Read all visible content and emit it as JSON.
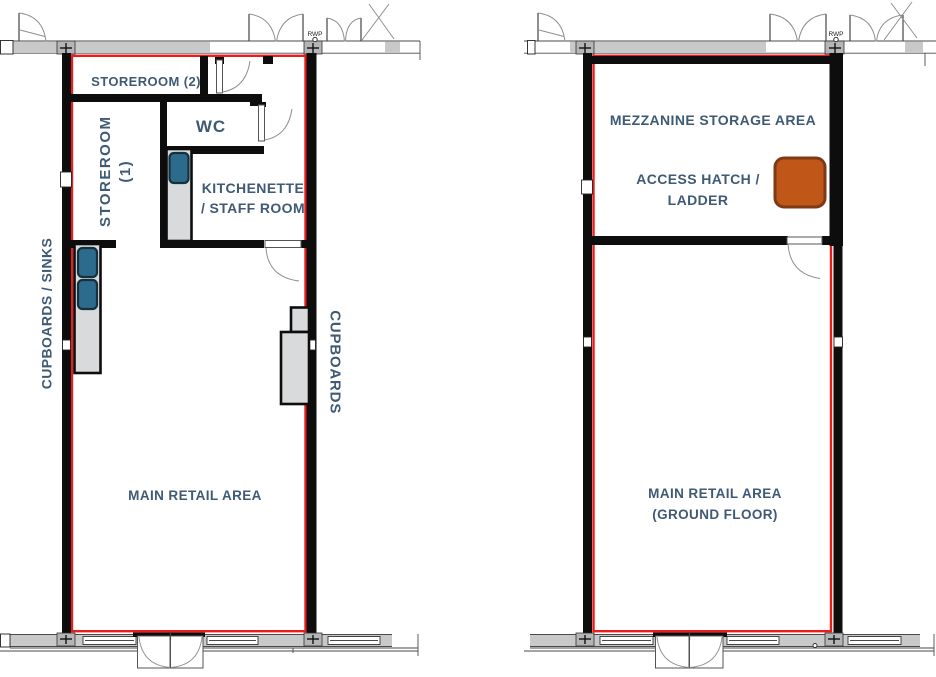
{
  "colors": {
    "wall_black": "#0d0d0d",
    "demise_red": "#ed1c1c",
    "band_gray": "#c8c9ca",
    "pillar_gray": "#b3b5b6",
    "counter_gray": "#d9dadb",
    "sink_blue": "#2d6b8d",
    "sink_border": "#14303c",
    "hatch_orange": "#c05617",
    "hatch_border": "#7d3a16",
    "label_blue": "#3e5a75",
    "arc_gray": "#8f8f8f"
  },
  "ground_floor": {
    "labels": {
      "storeroom2": "STOREROOM (2)",
      "storeroom1_line1": "STOREROOM",
      "storeroom1_line2": "(1)",
      "wc": "WC",
      "kitchenette_line1": "KITCHENETTE",
      "kitchenette_line2": "/ STAFF ROOM",
      "cupboards_sinks": "CUPBOARDS / SINKS",
      "cupboards": "CUPBOARDS",
      "main_retail": "MAIN RETAIL AREA",
      "rwp": "RWP"
    }
  },
  "mezzanine": {
    "labels": {
      "storage_area": "MEZZANINE STORAGE AREA",
      "access_hatch_line1": "ACCESS HATCH /",
      "access_hatch_line2": "LADDER",
      "main_retail_line1": "MAIN RETAIL AREA",
      "main_retail_line2": "(GROUND FLOOR)",
      "rwp": "RWP"
    }
  }
}
